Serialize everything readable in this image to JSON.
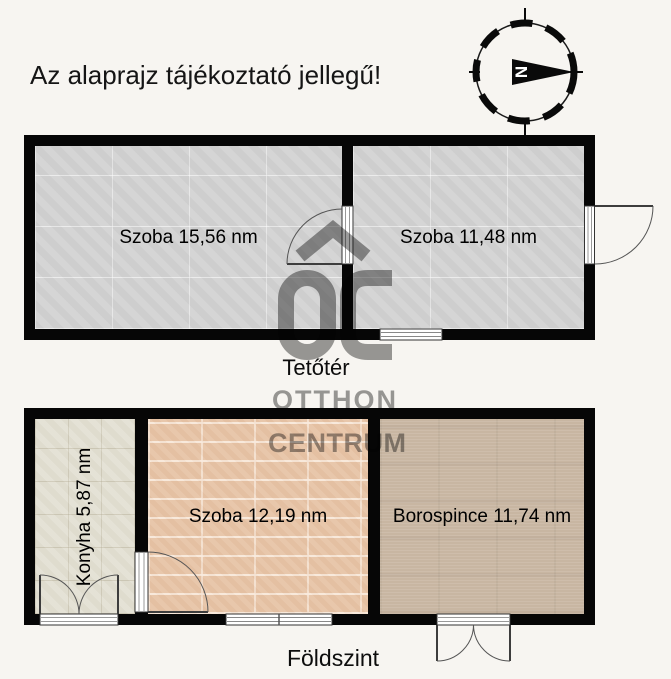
{
  "title": "Az alaprajz tájékoztató jellegű!",
  "compass": {
    "north_label": "N"
  },
  "watermark": {
    "logo_text": "OC",
    "line1": "OTTHON",
    "line2": "CENTRUM"
  },
  "floors": {
    "attic": {
      "label": "Tetőtér",
      "rooms": [
        {
          "name": "Szoba",
          "area_nm": "15,56",
          "label": "Szoba 15,56 nm"
        },
        {
          "name": "Szoba",
          "area_nm": "11,48",
          "label": "Szoba 11,48 nm"
        }
      ]
    },
    "ground": {
      "label": "Földszint",
      "rooms": [
        {
          "name": "Konyha",
          "area_nm": "5,87",
          "label": "Konyha 5,87 nm"
        },
        {
          "name": "Szoba",
          "area_nm": "12,19",
          "label": "Szoba 12,19 nm"
        },
        {
          "name": "Borospince",
          "area_nm": "11,74",
          "label": "Borospince 11,74 nm"
        }
      ]
    }
  },
  "colors": {
    "background": "#f7f5f1",
    "wall": "#060606",
    "attic_floor": "#d3d3d3",
    "kitchen_floor": "#e3e0d3",
    "ground_room_floor": "#e7c4a7",
    "cellar_floor": "#c8b6a2",
    "watermark_gray": "#9b9b9b"
  }
}
